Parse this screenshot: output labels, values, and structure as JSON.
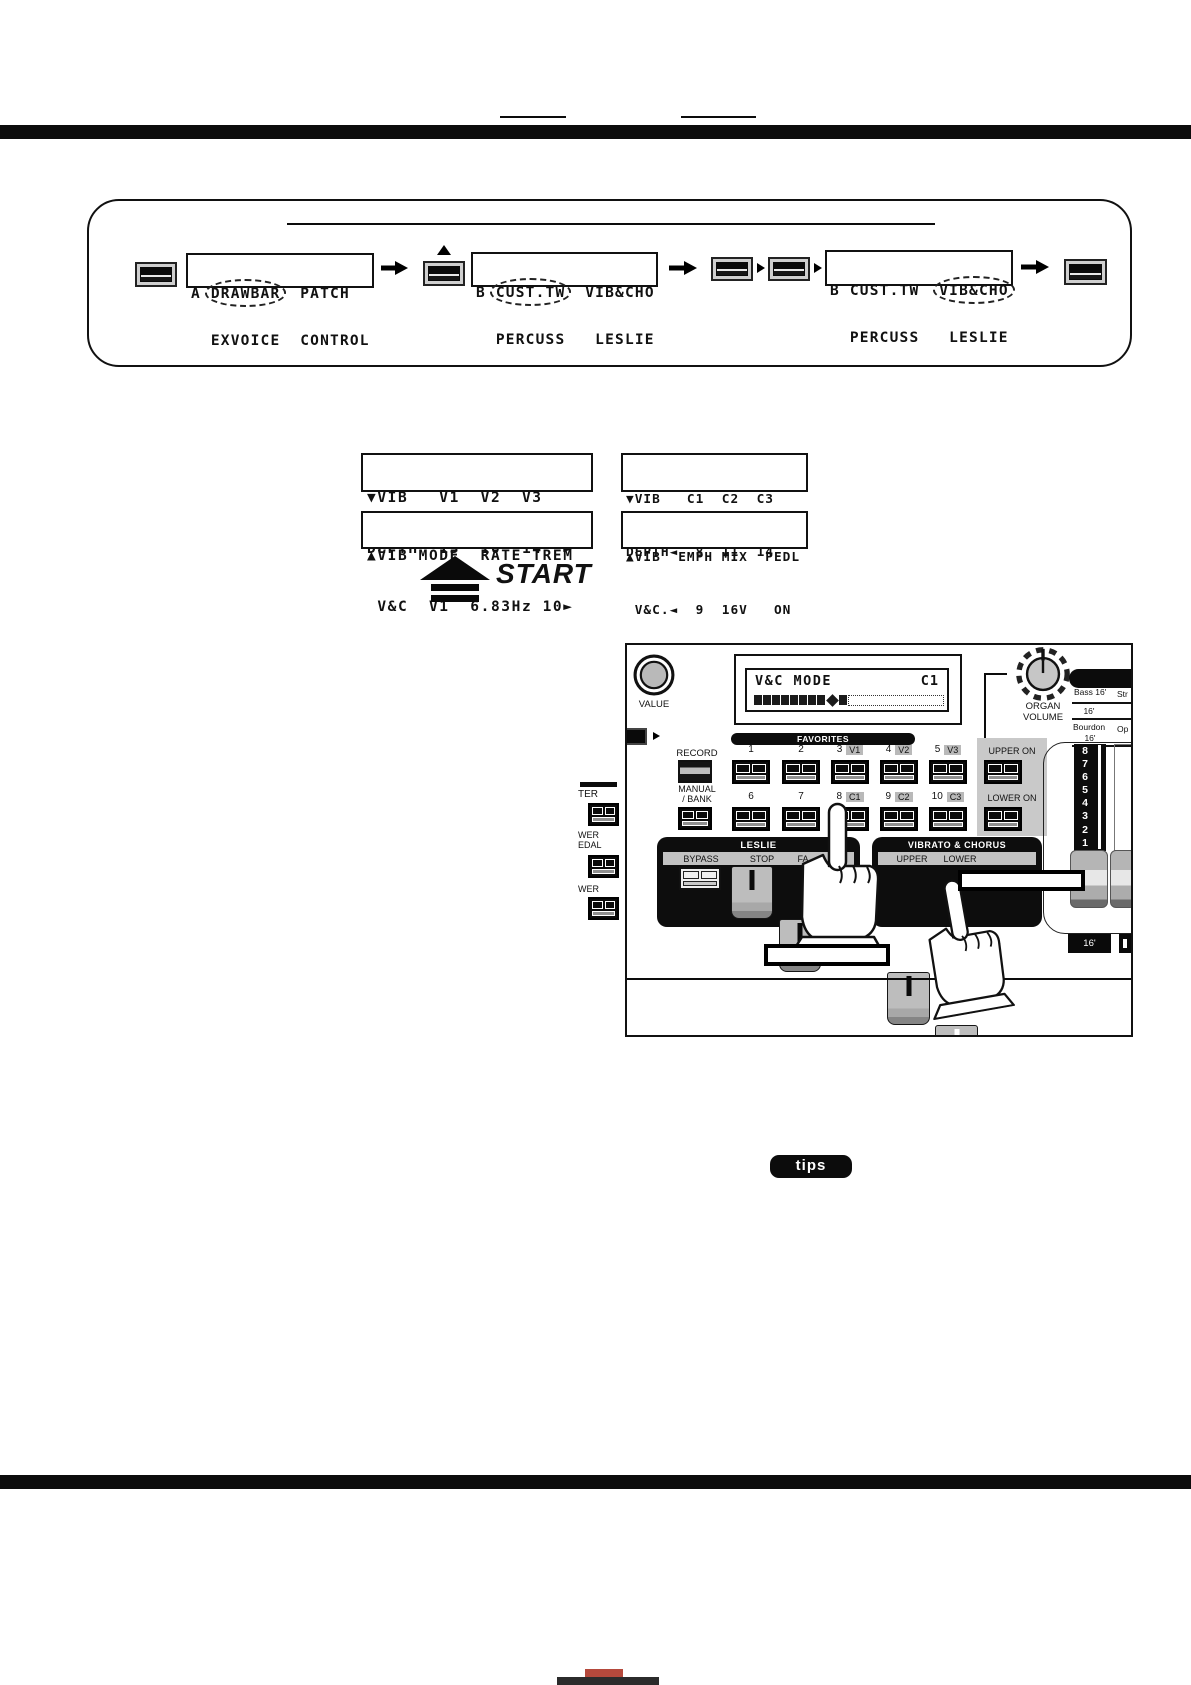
{
  "flowchart": {
    "lcd1": {
      "pre": "A ",
      "circled": "DRAWBAR",
      "post": "  PATCH",
      "line2": "  EXVOICE  CONTROL"
    },
    "lcd2": {
      "pre": "B ",
      "circled": "CUST.TW",
      "post": "  VIB&CHO",
      "line2": "  PERCUSS   LESLIE"
    },
    "lcd3": {
      "pre": "B CUST.TW  ",
      "circled": "VIB&CHO",
      "post": "",
      "line2": "  PERCUSS   LESLIE"
    }
  },
  "lcd_panels": {
    "vib_v": {
      "l1": "▼VIB   V1  V2  V3",
      "l2": "DEPTH  13  10  14  ►"
    },
    "vib_c": {
      "l1": "▼VIB   C1  C2  C3",
      "l2": "DEPTH◄  8  11  14"
    },
    "vib_mode": {
      "l1": "▲VIB MODE  RATE TREM",
      "l2": " V&C  V1  6.83Hz 10►"
    },
    "vib_emph": {
      "l1": "▲VIB  EMPH MIX  PEDL",
      "l2": " V&C.◄  9  16V   ON"
    }
  },
  "start_label": "START",
  "panel": {
    "value_label": "VALUE",
    "lcd": {
      "title": "V&C MODE",
      "value": "C1"
    },
    "organ_volume_line1": "ORGAN",
    "organ_volume_line2": "VOLUME",
    "favorites_title": "FAVORITES",
    "record_label": "RECORD",
    "manual_line1": "MANUAL",
    "manual_line2": "/ BANK",
    "fav_row1": [
      {
        "n": "1",
        "b": ""
      },
      {
        "n": "2",
        "b": ""
      },
      {
        "n": "3",
        "b": "V1"
      },
      {
        "n": "4",
        "b": "V2"
      },
      {
        "n": "5",
        "b": "V3"
      }
    ],
    "fav_row2": [
      {
        "n": "6",
        "b": ""
      },
      {
        "n": "7",
        "b": ""
      },
      {
        "n": "8",
        "b": "C1"
      },
      {
        "n": "9",
        "b": "C2"
      },
      {
        "n": "10",
        "b": "C3"
      }
    ],
    "upper_on": "UPPER ON",
    "lower_on": "LOWER ON",
    "leslie": {
      "title": "LESLIE",
      "bypass": "BYPASS",
      "stop": "STOP",
      "fast_partial": "FA"
    },
    "vibrato_chorus": {
      "title": "VIBRATO & CHORUS",
      "upper": "UPPER",
      "lower": "LOWER"
    },
    "drawbar_numbers": [
      "8",
      "7",
      "6",
      "5",
      "4",
      "3",
      "2",
      "1"
    ],
    "tone_labels": {
      "bass": "Bass 16'",
      "str": "Str",
      "mid": "16'",
      "bourdon": "Bourdon",
      "op": "Op",
      "bourdon_sub": "16'",
      "foot_tab": "16'"
    },
    "left_cut_labels": {
      "a": "TER",
      "b1": "WER",
      "b2": "EDAL",
      "c": "WER"
    }
  },
  "tips_label": "tips"
}
